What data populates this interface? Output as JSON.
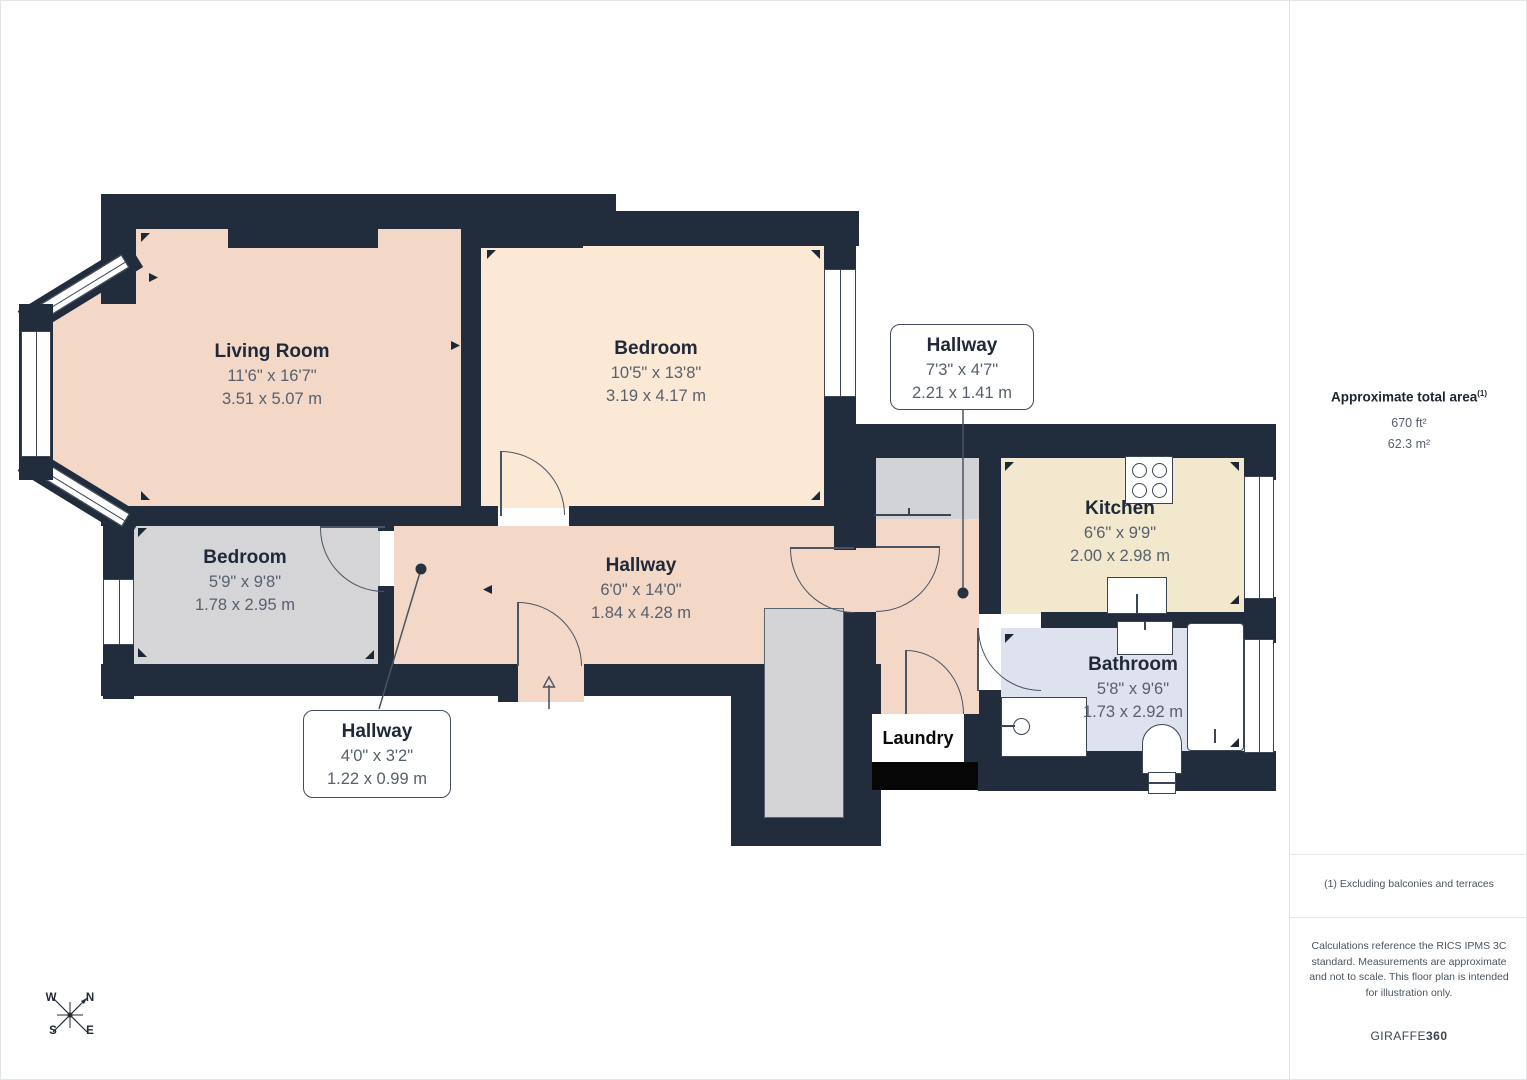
{
  "plan": {
    "rooms": {
      "living": {
        "name": "Living Room",
        "imperial": "11'6\" x 16'7\"",
        "metric": "3.51 x 5.07 m"
      },
      "bedroom_top": {
        "name": "Bedroom",
        "imperial": "10'5\" x 13'8\"",
        "metric": "3.19 x 4.17 m"
      },
      "bedroom_left": {
        "name": "Bedroom",
        "imperial": "5'9\" x 9'8\"",
        "metric": "1.78 x 2.95 m"
      },
      "hallway_main": {
        "name": "Hallway",
        "imperial": "6'0\" x 14'0\"",
        "metric": "1.84 x 4.28 m"
      },
      "kitchen": {
        "name": "Kitchen",
        "imperial": "6'6\" x 9'9\"",
        "metric": "2.00 x 2.98 m"
      },
      "bathroom": {
        "name": "Bathroom",
        "imperial": "5'8\" x 9'6\"",
        "metric": "1.73 x 2.92 m"
      },
      "laundry": {
        "name": "Laundry"
      }
    },
    "callouts": {
      "hallway_right": {
        "name": "Hallway",
        "imperial": "7'3\" x 4'7\"",
        "metric": "2.21 x 1.41 m"
      },
      "hallway_small": {
        "name": "Hallway",
        "imperial": "4'0\" x 3'2\"",
        "metric": "1.22 x 0.99 m"
      }
    },
    "compass": {
      "n": "N",
      "s": "S",
      "e": "E",
      "w": "W"
    }
  },
  "sidebar": {
    "area_title": "Approximate total area",
    "area_footnote_marker": "(1)",
    "area_ft": "670 ft²",
    "area_m": "62.3 m²",
    "footnote": "(1) Excluding balconies and terraces",
    "disclaimer": "Calculations reference the RICS IPMS 3C standard. Measurements are approximate and not to scale. This floor plan is intended for illustration only.",
    "brand_giraffe": "GIRAFFE",
    "brand_360": "360"
  },
  "colors": {
    "wall": "#212d3c",
    "living_hallway": "#f3d8c8",
    "bedroom_top": "#fbe9d6",
    "kitchen": "#f1e8ce",
    "bedroom_left_stairs": "#d5d5d8",
    "bathroom": "#dee2ee",
    "storage": "#d2d3d6",
    "laundry_block": "#060606"
  }
}
